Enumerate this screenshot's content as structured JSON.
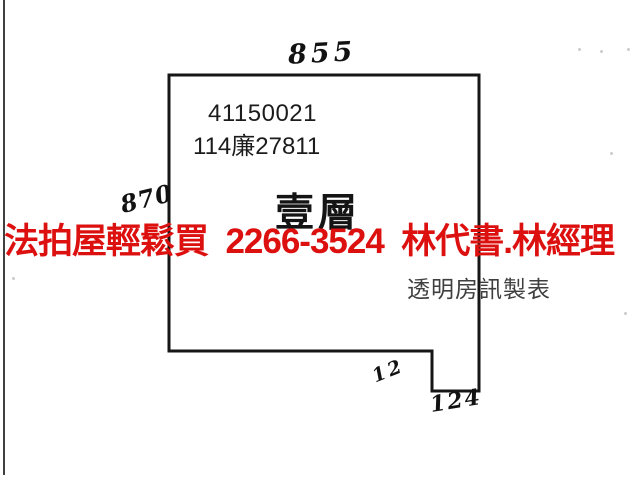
{
  "diagram": {
    "type": "floor-plan-scan",
    "parcel_number": "41150021",
    "case_number": "114廉27811",
    "floor_label": "壹層",
    "producer_credit": "透明房訊製表",
    "measurements": {
      "top_width": "855",
      "left_height": "870",
      "step_side": "12",
      "step_bottom": "124"
    },
    "outline": {
      "points": "169,75 479,75 479,391 432,391 432,351 169,351",
      "stroke": "#161616",
      "stroke_width": 3
    },
    "specks": [
      [
        578,
        48
      ],
      [
        600,
        50
      ],
      [
        627,
        48
      ],
      [
        610,
        152
      ],
      [
        624,
        312
      ],
      [
        12,
        277
      ]
    ]
  },
  "overlay_ad": {
    "text": "法拍屋輕鬆買  2266-3524  林代書.林經理",
    "color": "#dd1010"
  }
}
